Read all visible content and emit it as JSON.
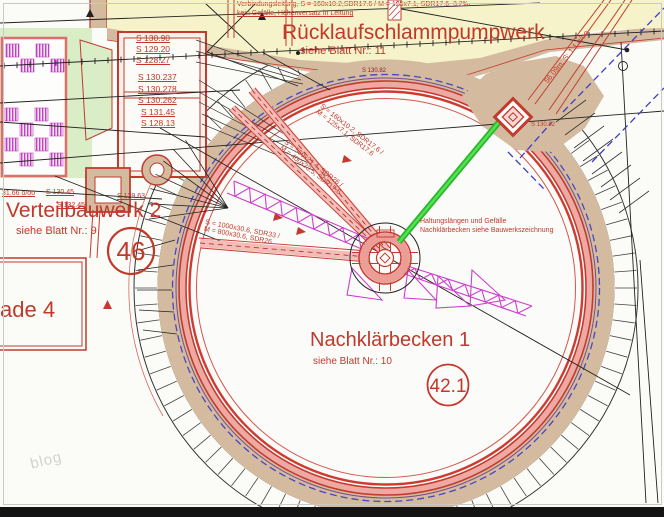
{
  "top_note": {
    "line1": "Verbindungsleitung, S = 160x10.2,SDR17.6 / M = 125x7.1, SDR17.6, 3.2‰",
    "line2": "kein Gefälle, Höhenversatz in Leitung"
  },
  "pump_station": {
    "title": "Rücklaufschlammpumpwerk",
    "subtitle": "siehe Blatt Nr.: 11"
  },
  "distribution": {
    "title": "Verteilbauwerk 2",
    "subtitle": "siehe Blatt Nr.: 9",
    "badge": "46"
  },
  "clarifier": {
    "title": "Nachklärbecken 1",
    "subtitle": "siehe Blatt Nr.: 10",
    "badge": "42.1",
    "note_line1": "Haltungslängen und Gefälle",
    "note_line2": "Nachklärbecken siehe Bauwerkszeichnung"
  },
  "partial_label": "ade 4",
  "elevations_upper": [
    "S 130.90",
    "S 129.20",
    "S 128.27"
  ],
  "elevations_lower": [
    "S 130.237",
    "S 130.278",
    "S 130.262",
    "S 131.45",
    "S 128.13"
  ],
  "left_labels": {
    "slope": "31.66 o/oo",
    "a": "S 130.45",
    "b": "S 129.63",
    "c": "S 132.45"
  },
  "pipe_labels": {
    "p1a": "S = 160x10.2, SDR17.6 /",
    "p1b": "M = 125x7.1, SDR17.6",
    "p2a": "S = 560x21.4, SDR26 /",
    "p2b": "M = 400x23.5, SDR17.6",
    "p3a": "S = 1000x30.6, SDR33 /",
    "p3b": "M = 800x30.6, SDR26",
    "diagonal": "56.09m, S: 1.1 o/oo",
    "outlet": "S 130.82",
    "wall_mark": "S 130.82"
  },
  "watermark": "blog",
  "colors": {
    "accent_red": "#c0392b",
    "line_red": "#c33b2f",
    "tan": "#d4bb9f",
    "yellow": "#f6f2c9",
    "green_area": "#d9edc6",
    "green_pipe": "#2fbe2f",
    "magenta": "#cc3fcc",
    "blue_dashed": "#3d3dc4",
    "wall_pink": "#eeaaa2"
  }
}
